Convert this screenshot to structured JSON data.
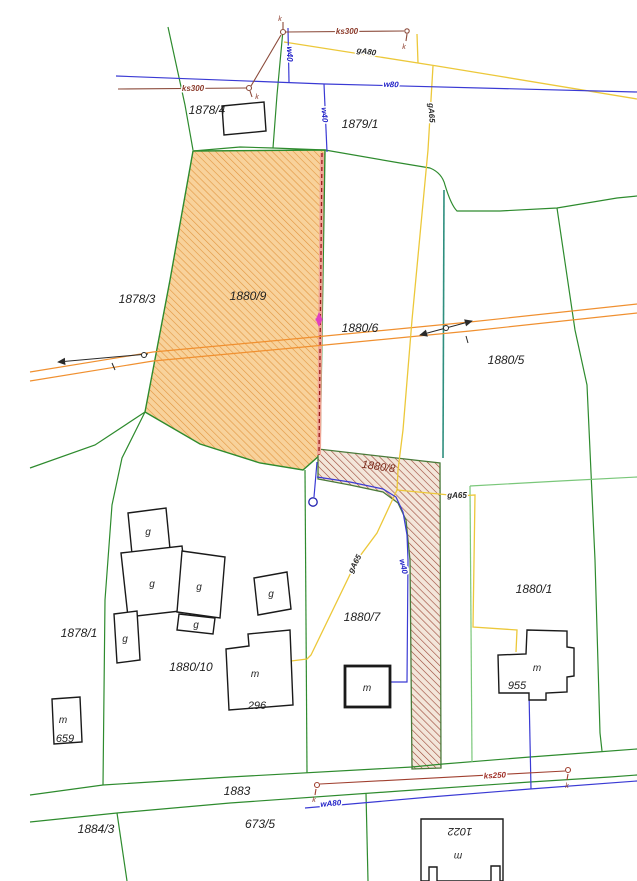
{
  "map_title": "cadastral-utility-map",
  "parcels": {
    "p1878_4": "1878/4",
    "p1879_1": "1879/1",
    "p1878_3": "1878/3",
    "p1880_9": "1880/9",
    "p1880_6": "1880/6",
    "p1880_5": "1880/5",
    "p1880_8": "1880/8",
    "p1878_1": "1878/1",
    "p1880_10": "1880/10",
    "p1880_7": "1880/7",
    "p1880_1": "1880/1",
    "p1883": "1883",
    "p1884_3": "1884/3",
    "p673_5": "673/5"
  },
  "buildings": {
    "g": "g",
    "m": "m",
    "n296": "296",
    "n659": "659",
    "n955": "955",
    "n1022": "1022"
  },
  "utilities": {
    "ks300": "ks300",
    "ks250": "ks250",
    "w80": "w80",
    "w40": "w40",
    "wA80": "wA80",
    "gA80": "gA80",
    "gA65": "gA65",
    "k": "k"
  },
  "colors": {
    "boundary_green": "#2e8b2e",
    "boundary_light_green": "#7ac77a",
    "teal_line": "#2f8f7f",
    "water_blue": "#3a3ad4",
    "gas_yellow": "#ecc83a",
    "sewer_brown": "#8b4a3a",
    "sewer_red": "#a04030",
    "power_orange": "#f09030",
    "parcel_fill_orange": "#f8d29b",
    "parcel_hatch_orange": "#e2953f",
    "claim_hatch_brown": "#9b4535",
    "claim_fill": "#f3e6da",
    "pink_band": "#f0a696",
    "dashed_red": "#9b1a1a",
    "magenta_mark": "#e040c0",
    "building_stroke": "#1a1a1a"
  }
}
